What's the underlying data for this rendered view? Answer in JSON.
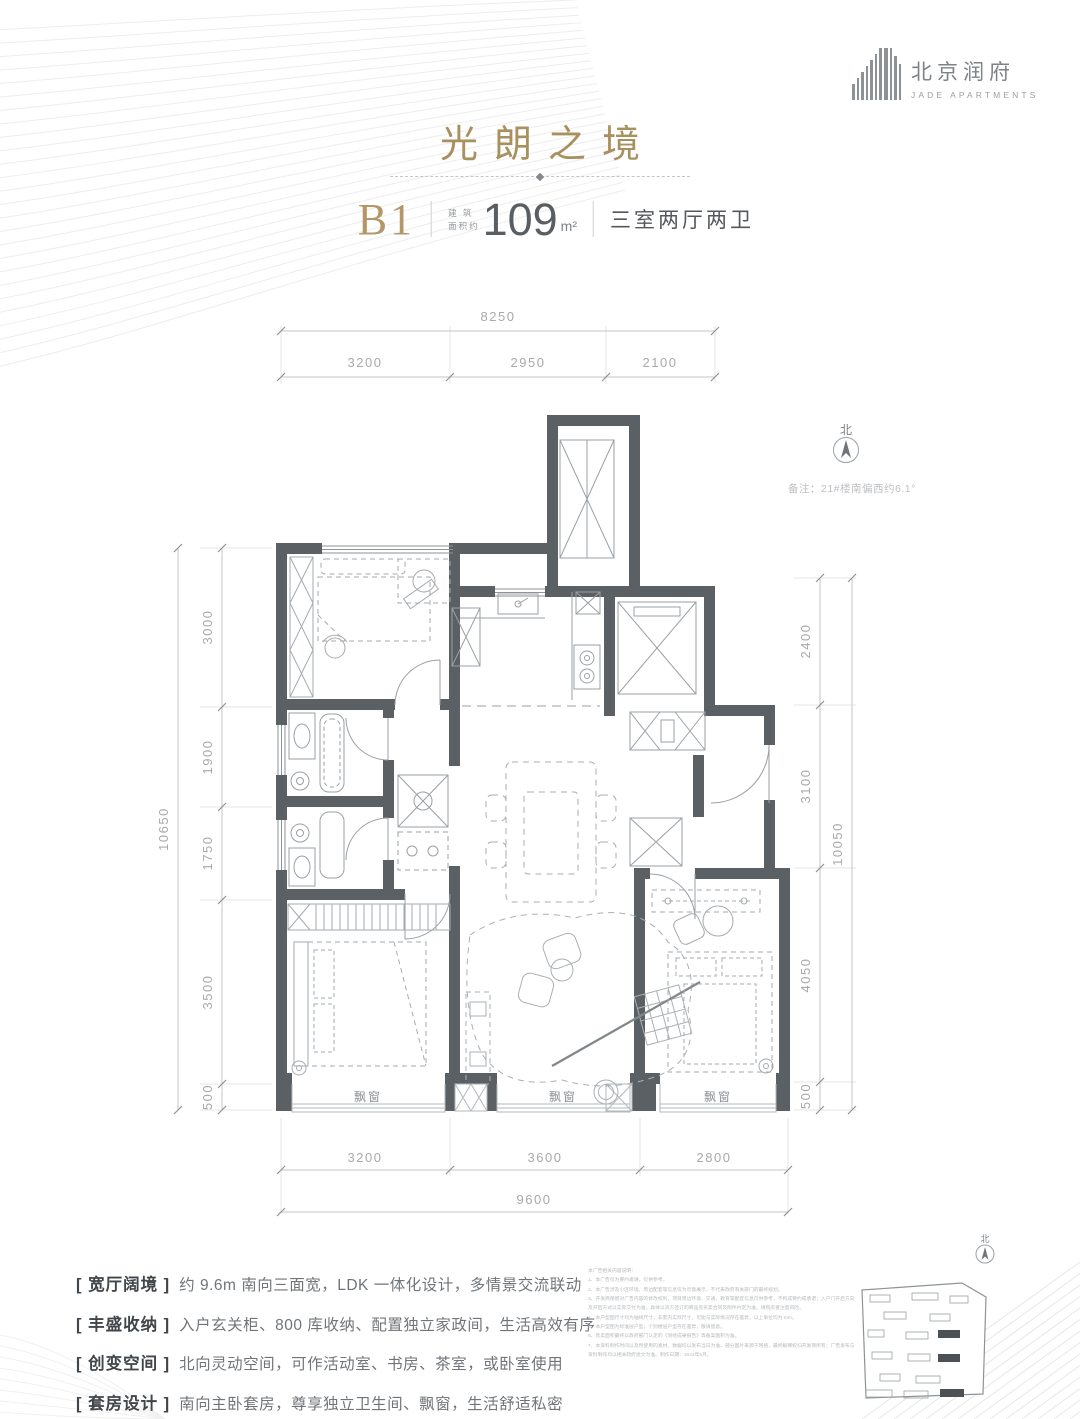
{
  "header": {
    "logo_cn": "北京润府",
    "logo_en": "JADE APARTMENTS",
    "title": "光朗之境",
    "unit": {
      "name": "B1",
      "area_label_line1": "建 筑",
      "area_label_line2": "面积约",
      "area_value": "109",
      "area_unit": "m²",
      "rooms": "三室两厅两卫"
    }
  },
  "plan": {
    "north_label": "北",
    "note": "备注：21#楼南偏西约6.1°",
    "bay_label": "飘窗",
    "dims": {
      "top_total": "8250",
      "top_segments": [
        "3200",
        "2950",
        "2100"
      ],
      "left_total": "10650",
      "left_segments": [
        "3000",
        "1900",
        "1750",
        "3500",
        "500"
      ],
      "right_total": "10050",
      "right_segments": [
        "2400",
        "3100",
        "4050",
        "500"
      ],
      "bottom_segments": [
        "3200",
        "3600",
        "2800"
      ],
      "bottom_total": "9600"
    }
  },
  "features": {
    "items": [
      {
        "label": "[ 宽厅阔境 ]",
        "text": "约 9.6m 南向三面宽，LDK 一体化设计，多情景交流联动"
      },
      {
        "label": "[ 丰盛收纳 ]",
        "text": "入户玄关柜、800 库收纳、配置独立家政间，生活高效有序"
      },
      {
        "label": "[ 创变空间 ]",
        "text": "北向灵动空间，可作活动室、书房、茶室，或卧室使用"
      },
      {
        "label": "[ 套房设计 ]",
        "text": "南向主卧套房，尊享独立卫生间、飘窗，生活舒适私密"
      }
    ]
  },
  "disclaimer": {
    "title": "本广告相关内容说明：",
    "items": [
      "1、本广告仅为要约邀请，仅供参考。",
      "2、本广告涉及小区环境、周边配套等信息仅为示意展示，不代表政府有关部门的最终规划。",
      "3、开发商保留对广告内容的修改权利，项目周边环境、交通、教育等配套信息仅供参考，不构成要约或承诺；入户门开启方向及开启方式以实际交付为准，具体以双方签订的商品房买卖合同及附件约定为准，请购房者注意风险。",
      "4、本户型图尺寸均为轴线尺寸，非套内实际尺寸，可能与实际情况存在差异，以上单位均为 mm。",
      "5、本户型图为标准层户型，个别楼层户型存在差异，敬请留意。",
      "6、售卖面积最终以政府部门认定的《测绘成果报告》等备案面积为准。",
      "7、本资料制作时间以及所使用的素材、数据均以发布当日为准，部分图片来源于网络，最终解释权归开发商所有；广告发布与资料制作均以相关政府批文为准。制作日期：2024年5月。"
    ]
  },
  "siteplan": {
    "north_label": "北"
  }
}
